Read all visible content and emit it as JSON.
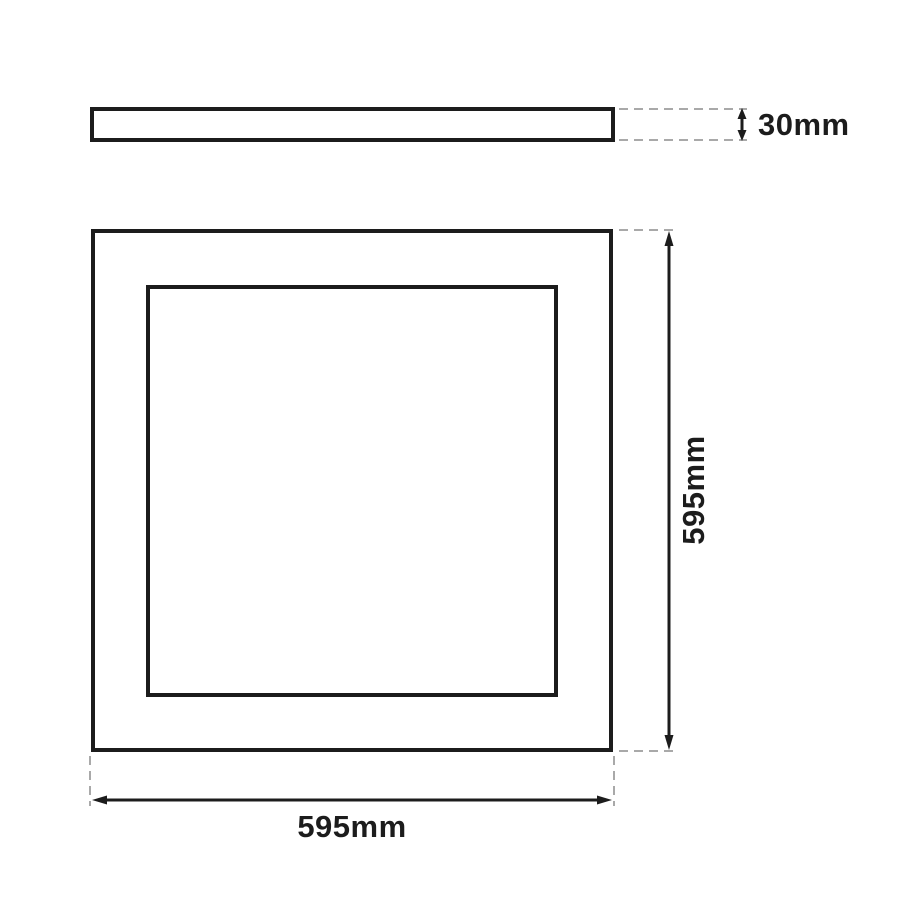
{
  "colors": {
    "background": "#ffffff",
    "line": "#1c1c1c",
    "extension": "#a9a9a9",
    "text": "#1c1c1c"
  },
  "views": {
    "side": {
      "thickness_label": "30mm"
    },
    "front": {
      "height_label": "595mm",
      "width_label": "595mm"
    }
  }
}
